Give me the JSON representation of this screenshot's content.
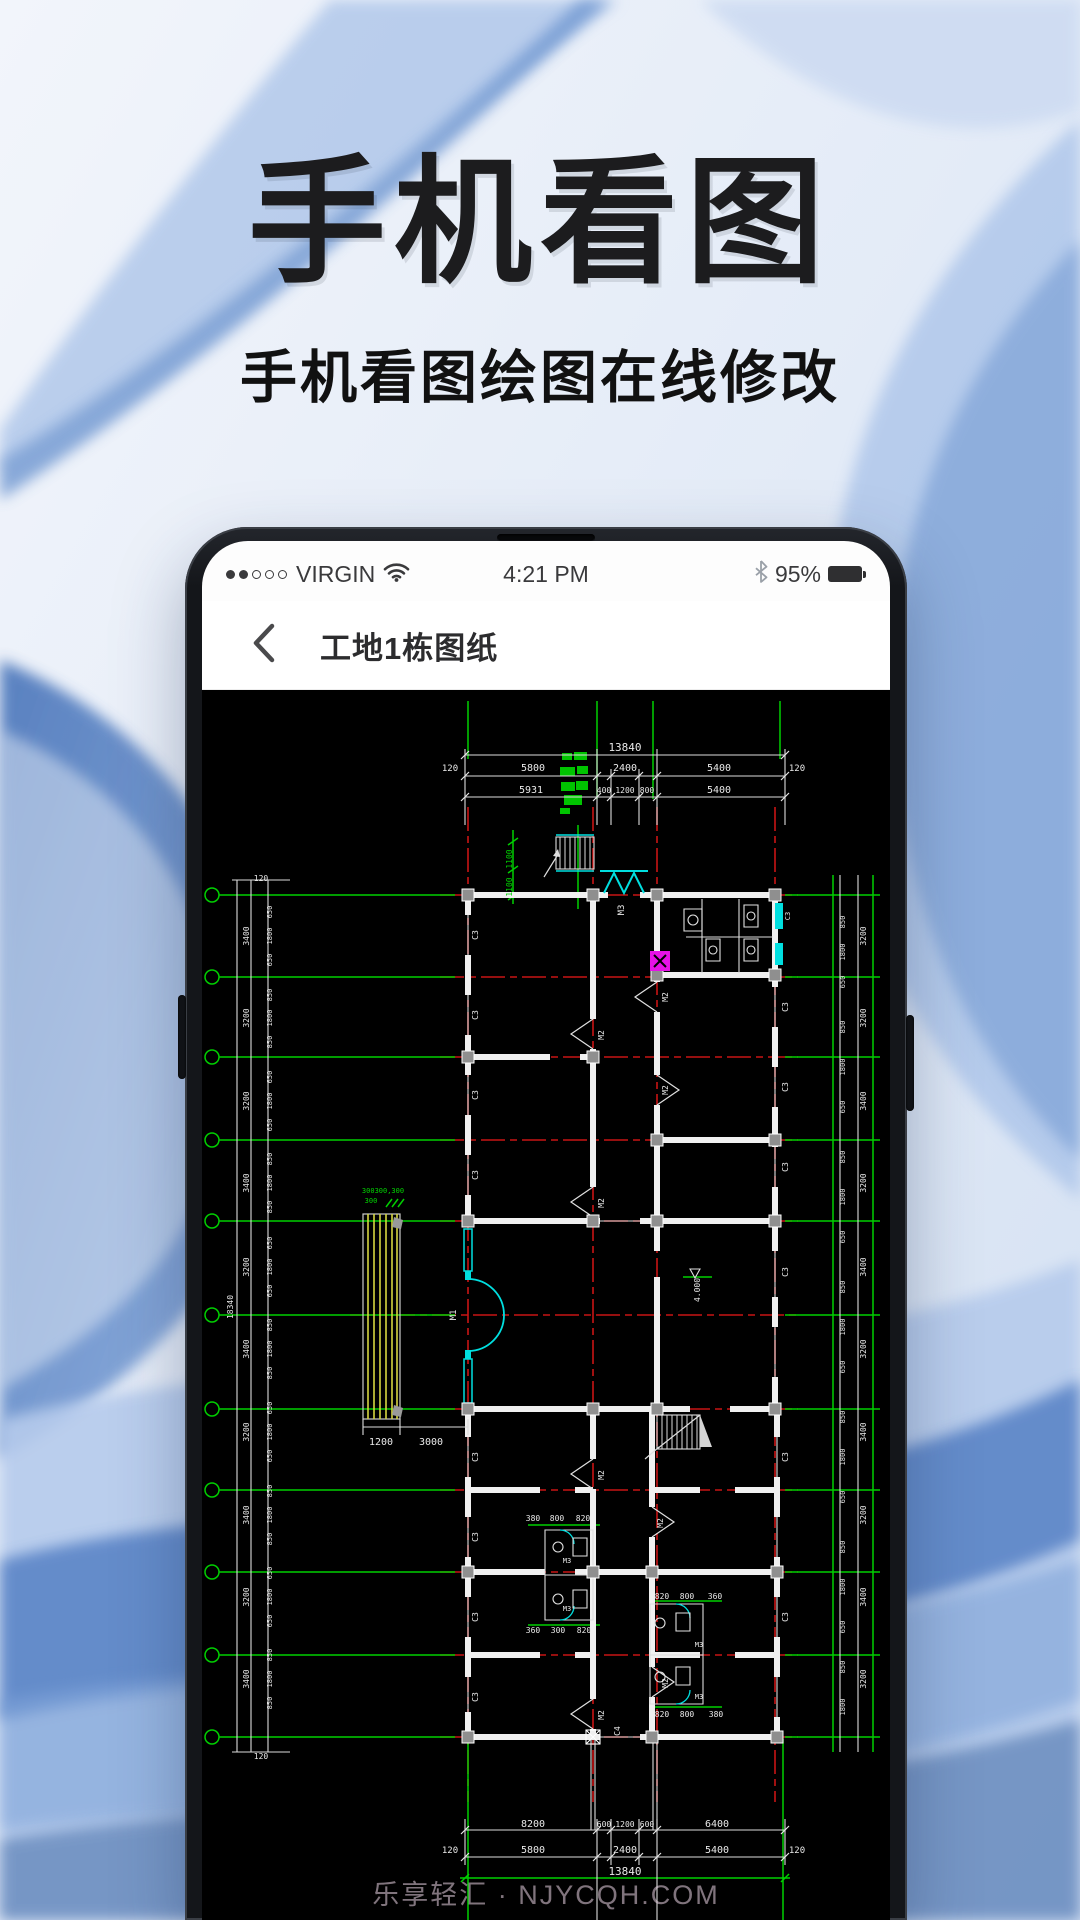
{
  "hero": {
    "title": "手机看图",
    "subtitle": "手机看图绘图在线修改"
  },
  "statusbar": {
    "carrier": "VIRGIN",
    "time": "4:21 PM",
    "battery_percent": "95%"
  },
  "navbar": {
    "title": "工地1栋图纸"
  },
  "watermark": "乐享轻汇 · NJYCQH.COM",
  "cad": {
    "drawing_name": "floor-plan",
    "colors": {
      "w": "#e9e9e9",
      "g": "#00d400",
      "c": "#00e0e0"
    },
    "texts": [
      [
        625,
        744,
        11,
        "w",
        0,
        "13840"
      ],
      [
        450,
        764,
        9,
        "w",
        0,
        "120"
      ],
      [
        533,
        764,
        10,
        "w",
        0,
        "5800"
      ],
      [
        625,
        764,
        10,
        "w",
        0,
        "2400"
      ],
      [
        719,
        764,
        10,
        "w",
        0,
        "5400"
      ],
      [
        797,
        764,
        9,
        "w",
        0,
        "120"
      ],
      [
        531,
        786,
        10,
        "w",
        0,
        "5931"
      ],
      [
        604,
        786,
        8,
        "w",
        0,
        "400"
      ],
      [
        625,
        786,
        8,
        "w",
        0,
        "1200"
      ],
      [
        647,
        786,
        8,
        "w",
        0,
        "800"
      ],
      [
        719,
        786,
        10,
        "w",
        0,
        "5400"
      ],
      [
        512,
        852,
        8,
        "g",
        -90,
        "1100"
      ],
      [
        512,
        880,
        8,
        "g",
        -90,
        "1100"
      ],
      [
        624,
        903,
        9,
        "w",
        -90,
        "M3"
      ],
      [
        383,
        1186,
        7,
        "g",
        0,
        "300300,300"
      ],
      [
        371,
        1196,
        7,
        "g",
        0,
        "300"
      ],
      [
        381,
        1438,
        10,
        "w",
        0,
        "1200"
      ],
      [
        431,
        1438,
        10,
        "w",
        0,
        "3000"
      ],
      [
        478,
        928,
        8,
        "w",
        -90,
        "C3"
      ],
      [
        478,
        1008,
        8,
        "w",
        -90,
        "C3"
      ],
      [
        478,
        1088,
        8,
        "w",
        -90,
        "C3"
      ],
      [
        478,
        1168,
        8,
        "w",
        -90,
        "C3"
      ],
      [
        478,
        1450,
        8,
        "w",
        -90,
        "C3"
      ],
      [
        478,
        1530,
        8,
        "w",
        -90,
        "C3"
      ],
      [
        478,
        1610,
        8,
        "w",
        -90,
        "C3"
      ],
      [
        478,
        1690,
        8,
        "w",
        -90,
        "C3"
      ],
      [
        790,
        909,
        7,
        "w",
        -90,
        "C3"
      ],
      [
        788,
        1000,
        8,
        "w",
        -90,
        "C3"
      ],
      [
        788,
        1080,
        8,
        "w",
        -90,
        "C3"
      ],
      [
        788,
        1160,
        8,
        "w",
        -90,
        "C3"
      ],
      [
        788,
        1265,
        8,
        "w",
        -90,
        "C3"
      ],
      [
        788,
        1450,
        8,
        "w",
        -90,
        "C3"
      ],
      [
        788,
        1610,
        8,
        "w",
        -90,
        "C3"
      ],
      [
        620,
        1724,
        8,
        "w",
        -90,
        "C4"
      ],
      [
        604,
        1028,
        8,
        "w",
        -90,
        "M2"
      ],
      [
        668,
        990,
        8,
        "w",
        -90,
        "M2"
      ],
      [
        668,
        1083,
        8,
        "w",
        -90,
        "M2"
      ],
      [
        604,
        1196,
        8,
        "w",
        -90,
        "M2"
      ],
      [
        456,
        1308,
        9,
        "w",
        -90,
        "M1"
      ],
      [
        604,
        1468,
        8,
        "w",
        -90,
        "M2"
      ],
      [
        663,
        1516,
        8,
        "w",
        -90,
        "M2"
      ],
      [
        604,
        1708,
        8,
        "w",
        -90,
        "M2"
      ],
      [
        668,
        1676,
        8,
        "w",
        -90,
        "M2"
      ],
      [
        533,
        1514,
        8,
        "w",
        0,
        "380"
      ],
      [
        557,
        1514,
        8,
        "w",
        0,
        "800"
      ],
      [
        583,
        1514,
        8,
        "w",
        0,
        "820"
      ],
      [
        533,
        1626,
        8,
        "w",
        0,
        "360"
      ],
      [
        558,
        1626,
        8,
        "w",
        0,
        "300"
      ],
      [
        584,
        1626,
        8,
        "w",
        0,
        "820"
      ],
      [
        662,
        1592,
        8,
        "w",
        0,
        "820"
      ],
      [
        687,
        1592,
        8,
        "w",
        0,
        "800"
      ],
      [
        715,
        1592,
        8,
        "w",
        0,
        "360"
      ],
      [
        662,
        1710,
        8,
        "w",
        0,
        "820"
      ],
      [
        687,
        1710,
        8,
        "w",
        0,
        "800"
      ],
      [
        716,
        1710,
        8,
        "w",
        0,
        "380"
      ],
      [
        567,
        1556,
        7,
        "w",
        0,
        "M3"
      ],
      [
        567,
        1604,
        7,
        "w",
        0,
        "M3"
      ],
      [
        699,
        1640,
        7,
        "w",
        0,
        "M3"
      ],
      [
        699,
        1692,
        7,
        "w",
        0,
        "M3"
      ],
      [
        700,
        1283,
        8,
        "w",
        -90,
        "4.000"
      ],
      [
        261,
        874,
        8,
        "w",
        0,
        "120"
      ],
      [
        261,
        1752,
        8,
        "w",
        0,
        "120"
      ],
      [
        272,
        905,
        7,
        "w",
        -90,
        "650"
      ],
      [
        272,
        929,
        7,
        "w",
        -90,
        "1800"
      ],
      [
        272,
        953,
        7,
        "w",
        -90,
        "650"
      ],
      [
        272,
        988,
        7,
        "w",
        -90,
        "850"
      ],
      [
        272,
        1011,
        7,
        "w",
        -90,
        "1800"
      ],
      [
        272,
        1035,
        7,
        "w",
        -90,
        "850"
      ],
      [
        272,
        1070,
        7,
        "w",
        -90,
        "650"
      ],
      [
        272,
        1094,
        7,
        "w",
        -90,
        "1800"
      ],
      [
        272,
        1118,
        7,
        "w",
        -90,
        "650"
      ],
      [
        272,
        1152,
        7,
        "w",
        -90,
        "850"
      ],
      [
        272,
        1176,
        7,
        "w",
        -90,
        "1800"
      ],
      [
        272,
        1200,
        7,
        "w",
        -90,
        "850"
      ],
      [
        272,
        1236,
        7,
        "w",
        -90,
        "650"
      ],
      [
        272,
        1260,
        7,
        "w",
        -90,
        "1800"
      ],
      [
        272,
        1284,
        7,
        "w",
        -90,
        "650"
      ],
      [
        272,
        1318,
        7,
        "w",
        -90,
        "850"
      ],
      [
        272,
        1342,
        7,
        "w",
        -90,
        "1800"
      ],
      [
        272,
        1366,
        7,
        "w",
        -90,
        "850"
      ],
      [
        272,
        1401,
        7,
        "w",
        -90,
        "650"
      ],
      [
        272,
        1425,
        7,
        "w",
        -90,
        "1800"
      ],
      [
        272,
        1449,
        7,
        "w",
        -90,
        "650"
      ],
      [
        272,
        1484,
        7,
        "w",
        -90,
        "850"
      ],
      [
        272,
        1508,
        7,
        "w",
        -90,
        "1800"
      ],
      [
        272,
        1532,
        7,
        "w",
        -90,
        "850"
      ],
      [
        272,
        1566,
        7,
        "w",
        -90,
        "650"
      ],
      [
        272,
        1590,
        7,
        "w",
        -90,
        "1800"
      ],
      [
        272,
        1614,
        7,
        "w",
        -90,
        "650"
      ],
      [
        272,
        1648,
        7,
        "w",
        -90,
        "850"
      ],
      [
        272,
        1672,
        7,
        "w",
        -90,
        "1800"
      ],
      [
        272,
        1696,
        7,
        "w",
        -90,
        "850"
      ],
      [
        249,
        929,
        8,
        "w",
        -90,
        "3400"
      ],
      [
        249,
        1011,
        8,
        "w",
        -90,
        "3200"
      ],
      [
        249,
        1094,
        8,
        "w",
        -90,
        "3200"
      ],
      [
        249,
        1176,
        8,
        "w",
        -90,
        "3400"
      ],
      [
        249,
        1260,
        8,
        "w",
        -90,
        "3200"
      ],
      [
        249,
        1342,
        8,
        "w",
        -90,
        "3400"
      ],
      [
        249,
        1425,
        8,
        "w",
        -90,
        "3200"
      ],
      [
        249,
        1508,
        8,
        "w",
        -90,
        "3400"
      ],
      [
        249,
        1590,
        8,
        "w",
        -90,
        "3200"
      ],
      [
        249,
        1672,
        8,
        "w",
        -90,
        "3400"
      ],
      [
        233,
        1300,
        8,
        "w",
        -90,
        "18340"
      ],
      [
        845,
        915,
        7,
        "w",
        -90,
        "850"
      ],
      [
        845,
        945,
        7,
        "w",
        -90,
        "1800"
      ],
      [
        845,
        975,
        7,
        "w",
        -90,
        "650"
      ],
      [
        845,
        1020,
        7,
        "w",
        -90,
        "850"
      ],
      [
        845,
        1060,
        7,
        "w",
        -90,
        "1800"
      ],
      [
        845,
        1100,
        7,
        "w",
        -90,
        "650"
      ],
      [
        845,
        1150,
        7,
        "w",
        -90,
        "850"
      ],
      [
        845,
        1190,
        7,
        "w",
        -90,
        "1800"
      ],
      [
        845,
        1230,
        7,
        "w",
        -90,
        "650"
      ],
      [
        845,
        1280,
        7,
        "w",
        -90,
        "850"
      ],
      [
        845,
        1320,
        7,
        "w",
        -90,
        "1800"
      ],
      [
        845,
        1360,
        7,
        "w",
        -90,
        "650"
      ],
      [
        845,
        1410,
        7,
        "w",
        -90,
        "850"
      ],
      [
        845,
        1450,
        7,
        "w",
        -90,
        "1800"
      ],
      [
        845,
        1490,
        7,
        "w",
        -90,
        "650"
      ],
      [
        845,
        1540,
        7,
        "w",
        -90,
        "850"
      ],
      [
        845,
        1580,
        7,
        "w",
        -90,
        "1800"
      ],
      [
        845,
        1620,
        7,
        "w",
        -90,
        "650"
      ],
      [
        845,
        1660,
        7,
        "w",
        -90,
        "850"
      ],
      [
        845,
        1700,
        7,
        "w",
        -90,
        "1800"
      ],
      [
        866,
        929,
        8,
        "w",
        -90,
        "3200"
      ],
      [
        866,
        1011,
        8,
        "w",
        -90,
        "3200"
      ],
      [
        866,
        1094,
        8,
        "w",
        -90,
        "3400"
      ],
      [
        866,
        1176,
        8,
        "w",
        -90,
        "3200"
      ],
      [
        866,
        1260,
        8,
        "w",
        -90,
        "3400"
      ],
      [
        866,
        1342,
        8,
        "w",
        -90,
        "3200"
      ],
      [
        866,
        1425,
        8,
        "w",
        -90,
        "3400"
      ],
      [
        866,
        1508,
        8,
        "w",
        -90,
        "3200"
      ],
      [
        866,
        1590,
        8,
        "w",
        -90,
        "3400"
      ],
      [
        866,
        1672,
        8,
        "w",
        -90,
        "3200"
      ],
      [
        533,
        1820,
        10,
        "w",
        0,
        "8200"
      ],
      [
        604,
        1820,
        8,
        "w",
        0,
        "600"
      ],
      [
        625,
        1820,
        8,
        "w",
        0,
        "1200"
      ],
      [
        647,
        1820,
        8,
        "w",
        0,
        "600"
      ],
      [
        717,
        1820,
        10,
        "w",
        0,
        "6400"
      ],
      [
        450,
        1846,
        9,
        "w",
        0,
        "120"
      ],
      [
        533,
        1846,
        10,
        "w",
        0,
        "5800"
      ],
      [
        625,
        1846,
        10,
        "w",
        0,
        "2400"
      ],
      [
        717,
        1846,
        10,
        "w",
        0,
        "5400"
      ],
      [
        797,
        1846,
        9,
        "w",
        0,
        "120"
      ],
      [
        625,
        1868,
        11,
        "w",
        0,
        "13840"
      ]
    ]
  }
}
